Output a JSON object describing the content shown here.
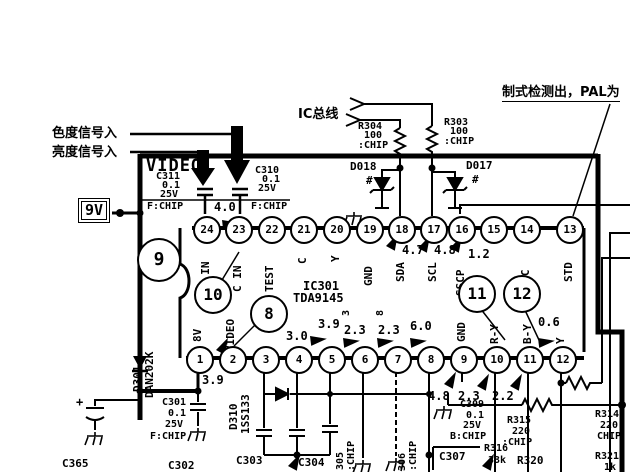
{
  "annotations": {
    "chroma_in": "色度信号入",
    "luma_in": "亮度信号入",
    "ic_bus": "IC总线",
    "std_detect": "制式检测出，PAL为",
    "video_block": "VIDEO",
    "supply": "9V"
  },
  "ic": {
    "ref": "IC301",
    "part": "TDA9145",
    "top_pins": [
      {
        "n": "24",
        "label": "Y IN"
      },
      {
        "n": "23",
        "label": "C IN"
      },
      {
        "n": "22",
        "label": "TEST"
      },
      {
        "n": "21",
        "label": "C"
      },
      {
        "n": "20",
        "label": "Y"
      },
      {
        "n": "19",
        "label": "GND"
      },
      {
        "n": "18",
        "label": "SDA",
        "v": "4.7"
      },
      {
        "n": "17",
        "label": "SCL",
        "v": "4.8"
      },
      {
        "n": "16",
        "label": "SSCP",
        "v": "1.2"
      },
      {
        "n": "15",
        "label": ""
      },
      {
        "n": "14",
        "label": "2FSC"
      },
      {
        "n": "13",
        "label": "STD"
      }
    ],
    "bottom_pins": [
      {
        "n": "1",
        "label": "8V"
      },
      {
        "n": "2",
        "label": "VIDEO"
      },
      {
        "n": "3",
        "label": ""
      },
      {
        "n": "4",
        "label": ""
      },
      {
        "n": "5",
        "label": ""
      },
      {
        "n": "6",
        "label": ""
      },
      {
        "n": "7",
        "label": ""
      },
      {
        "n": "8",
        "label": ""
      },
      {
        "n": "9",
        "label": "GND"
      },
      {
        "n": "10",
        "label": "R-Y"
      },
      {
        "n": "11",
        "label": "B-Y"
      },
      {
        "n": "12",
        "label": "Y"
      }
    ]
  },
  "callouts": {
    "c8": "8",
    "c9": "9",
    "c10": "10",
    "c11": "11",
    "c12": "12"
  },
  "voltages": {
    "video_line": "4.0",
    "pin2_below": "3.9",
    "pin4": "3.0",
    "pin5": "3.9",
    "pin6": "2.3",
    "pin6_alt": "3",
    "pin7": "2.3",
    "pin7_alt": "8",
    "pin8": "6.0",
    "pin12": "0.6",
    "row_a": "4.8",
    "row_b": "2.3",
    "row_c": "2.2"
  },
  "components": {
    "c311": {
      "ref": "C311",
      "l1": "0.1",
      "l2": "25V",
      "l3": "F:CHIP"
    },
    "c310": {
      "ref": "C310",
      "l1": "0.1",
      "l2": "25V",
      "l3": "F:CHIP"
    },
    "r304": {
      "ref": "R304",
      "l1": "100",
      "l2": ":CHIP"
    },
    "r303": {
      "ref": "R303",
      "l1": "100",
      "l2": ":CHIP"
    },
    "d018": {
      "ref": "D018",
      "mark": "#"
    },
    "d017": {
      "ref": "D017",
      "mark": "#"
    },
    "d301": {
      "ref": "D301",
      "part": "DAN202K"
    },
    "d310": {
      "ref": "D310",
      "part": "1SS133"
    },
    "c301": {
      "ref": "C301",
      "l1": "0.1",
      "l2": "25V",
      "l3": "F:CHIP"
    },
    "c365": {
      "ref": "C365"
    },
    "c302": {
      "ref": "C302"
    },
    "c303": {
      "ref": "C303"
    },
    "c304": {
      "ref": "C304"
    },
    "c305": {
      "ref": "305",
      "l1": ":CHIP"
    },
    "c306": {
      "ref": "306",
      "l1": ":CHIP"
    },
    "c307": {
      "ref": "C307"
    },
    "c309": {
      "ref": "C309",
      "l1": "0.1",
      "l2": "25V",
      "l3": "B:CHIP"
    },
    "r315": {
      "ref": "R315",
      "l1": "220",
      "l2": ":CHIP"
    },
    "r316": {
      "ref": "R316",
      "l1": "33k"
    },
    "r320": {
      "ref": "R320"
    },
    "r314": {
      "ref": "R314",
      "l1": "220",
      "l2": "CHIP"
    },
    "r321": {
      "ref": "R321",
      "l1": "1k"
    },
    "plus": "+"
  }
}
